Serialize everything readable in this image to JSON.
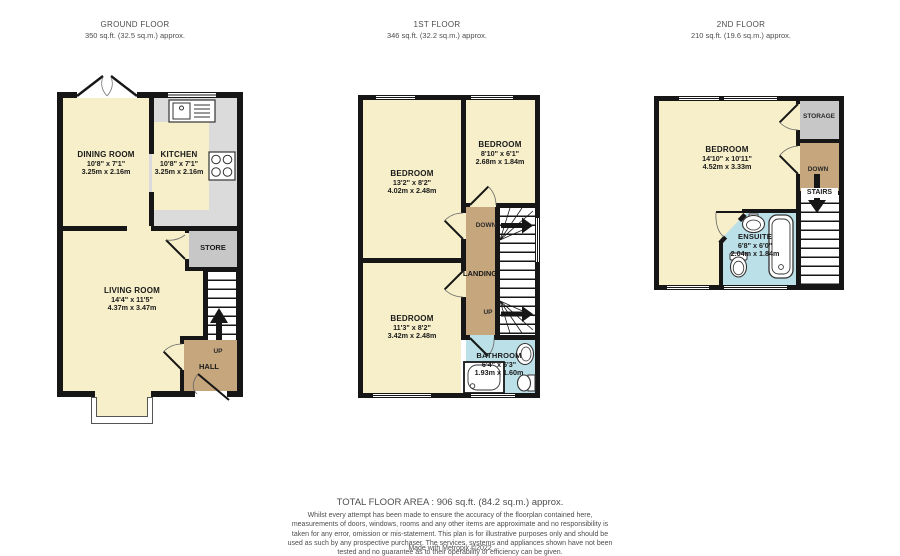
{
  "headers": [
    {
      "title": "GROUND FLOOR",
      "area": "350 sq.ft. (32.5 sq.m.) approx."
    },
    {
      "title": "1ST FLOOR",
      "area": "346 sq.ft. (32.2 sq.m.) approx."
    },
    {
      "title": "2ND FLOOR",
      "area": "210 sq.ft. (19.6 sq.m.) approx."
    }
  ],
  "ground": {
    "dining": {
      "name": "DINING ROOM",
      "ft": "10'8\" x 7'1\"",
      "m": "3.25m x 2.16m"
    },
    "kitchen": {
      "name": "KITCHEN",
      "ft": "10'8\" x 7'1\"",
      "m": "3.25m x 2.16m"
    },
    "living": {
      "name": "LIVING ROOM",
      "ft": "14'4\" x 11'5\"",
      "m": "4.37m x 3.47m"
    },
    "store": "STORE",
    "hall": "HALL",
    "up": "UP"
  },
  "first": {
    "bed1": {
      "name": "BEDROOM",
      "ft": "13'2\" x 8'2\"",
      "m": "4.02m x 2.48m"
    },
    "bed2": {
      "name": "BEDROOM",
      "ft": "8'10\" x 6'1\"",
      "m": "2.68m x 1.84m"
    },
    "bed3": {
      "name": "BEDROOM",
      "ft": "11'3\" x 8'2\"",
      "m": "3.42m x 2.48m"
    },
    "bathroom": {
      "name": "BATHROOM",
      "ft": "6'4\" x 5'3\"",
      "m": "1.93m x 1.60m"
    },
    "landing": "LANDING",
    "down": "DOWN",
    "up": "UP"
  },
  "second": {
    "bedroom": {
      "name": "BEDROOM",
      "ft": "14'10\" x 10'11\"",
      "m": "4.52m x 3.33m"
    },
    "ensuite": {
      "name": "ENSUITE",
      "ft": "6'8\" x 6'0\"",
      "m": "2.04m x 1.84m"
    },
    "storage": "STORAGE",
    "down": "DOWN",
    "stairs": "STAIRS"
  },
  "footer": {
    "total": "TOTAL FLOOR AREA : 906 sq.ft. (84.2 sq.m.) approx.",
    "disclaimer": "Whilst every attempt has been made to ensure the accuracy of the floorplan contained here, measurements of doors, windows, rooms and any other items are approximate and no responsibility is taken for any error, omission or mis-statement. This plan is for illustrative purposes only and should be used as such by any prospective purchaser. The services, systems and appliances shown have not been tested and no guarantee as to their operability or efficiency can be given.",
    "credit": "Made with Metropix ©2022"
  },
  "colors": {
    "wall": "#161616",
    "room_cream": "#F6EFC9",
    "hall_brown": "#C5A67D",
    "store_gray": "#C7C7C7",
    "counter_gray": "#DBDBDB",
    "bath_blue": "#BCE0E8"
  }
}
